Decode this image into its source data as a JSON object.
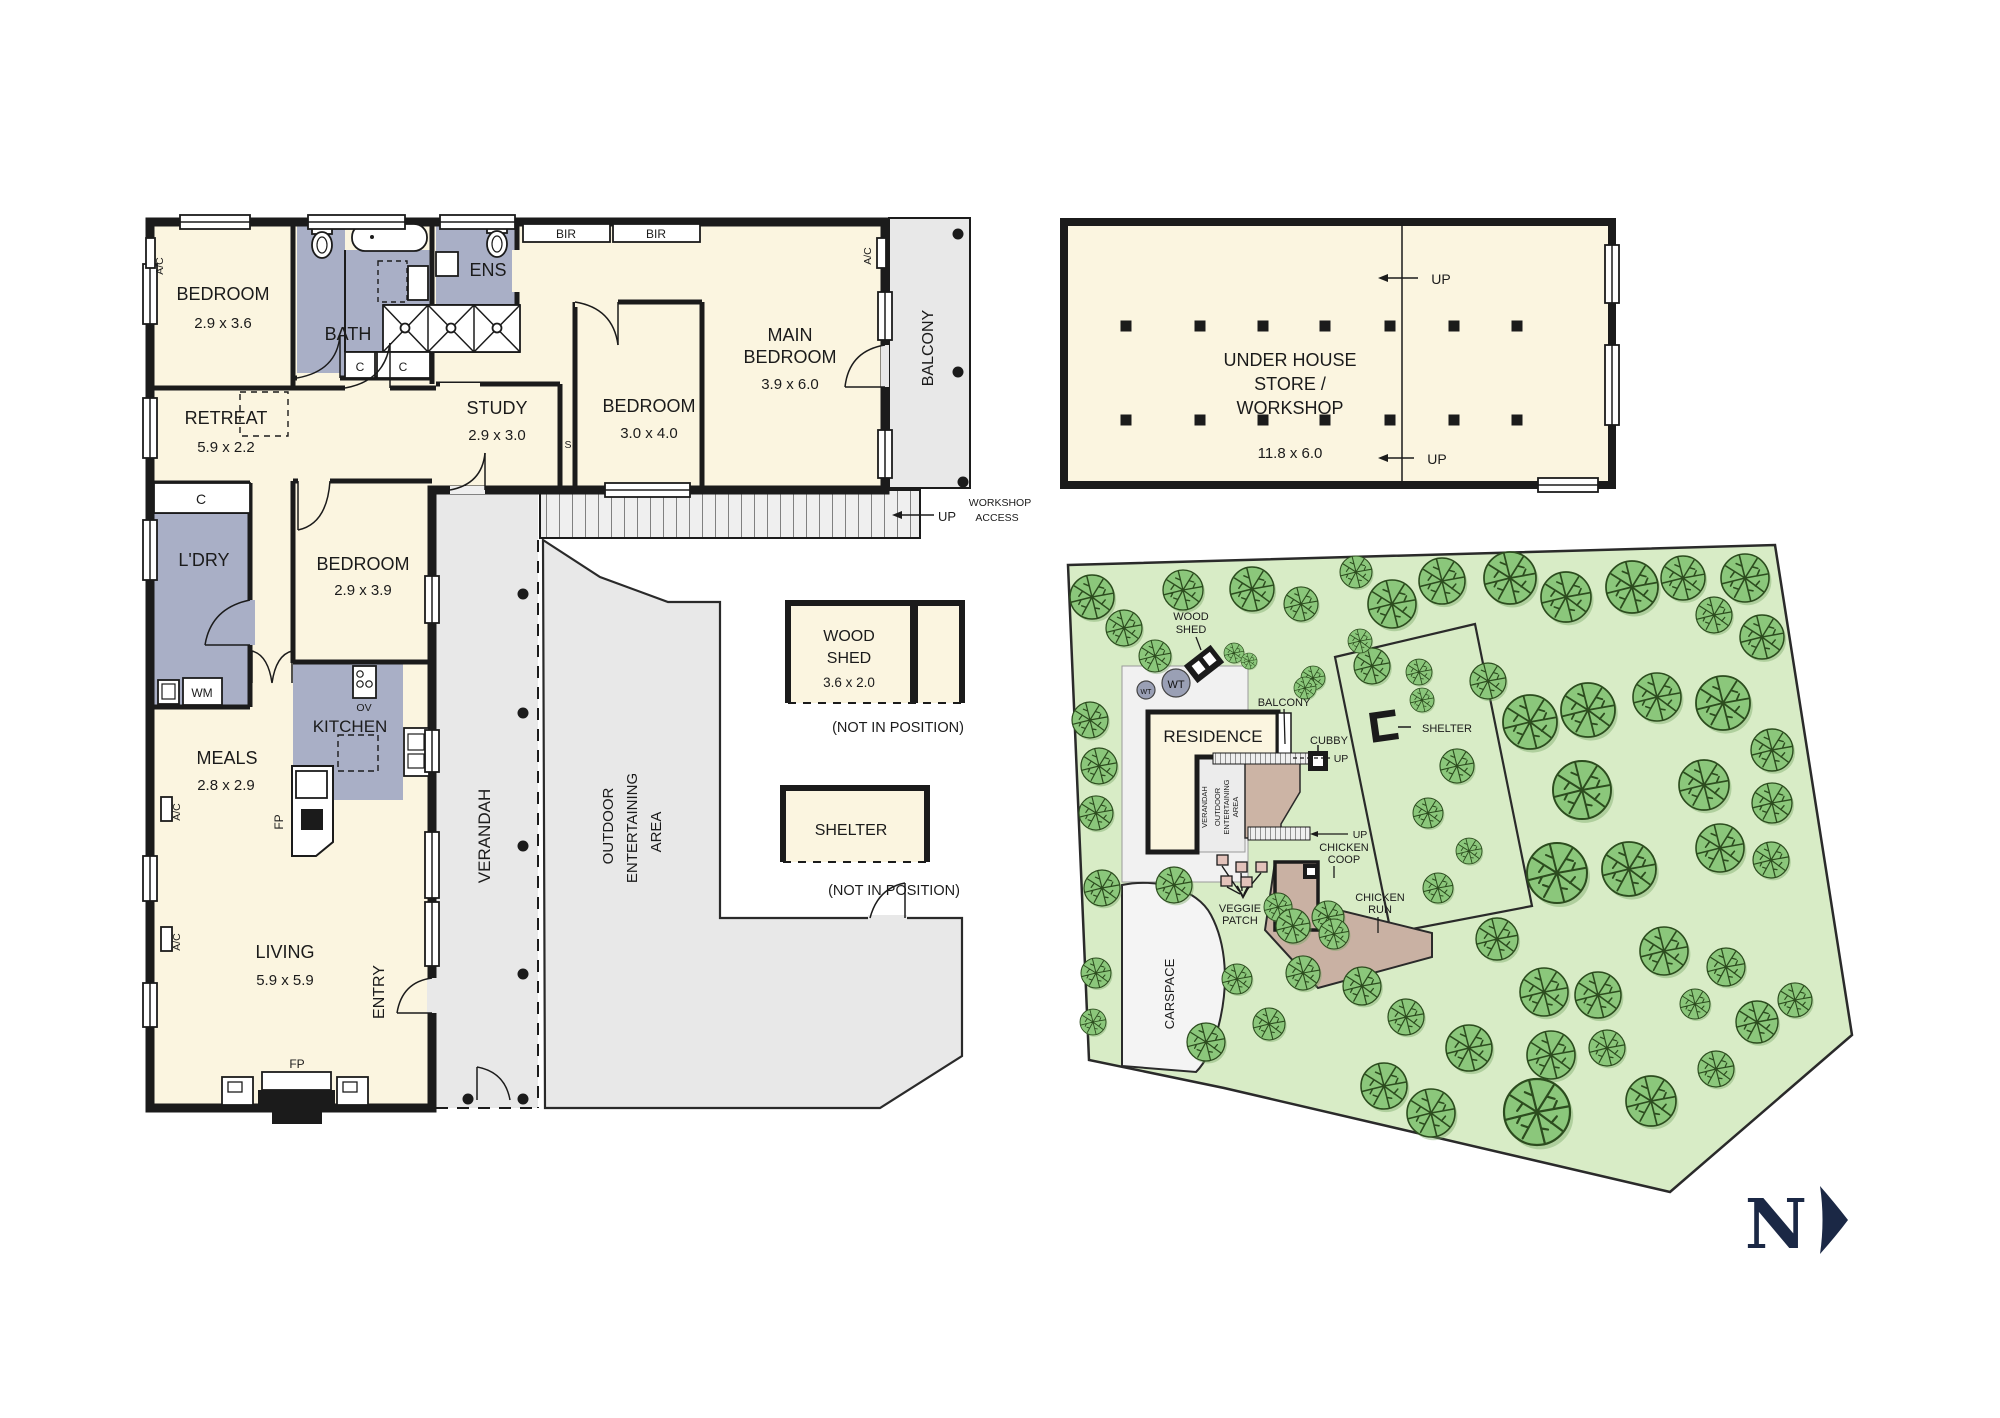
{
  "fp": {
    "bedroom1": [
      "BEDROOM",
      "2.9 x 3.6"
    ],
    "bath": "BATH",
    "ens": "ENS",
    "bir": "BIR",
    "main_bedroom": [
      "MAIN",
      "BEDROOM",
      "3.9 x 6.0"
    ],
    "balcony": "BALCONY",
    "bedroom3": [
      "BEDROOM",
      "3.0 x 4.0"
    ],
    "study": [
      "STUDY",
      "2.9 x 3.0"
    ],
    "retreat": [
      "RETREAT",
      "5.9 x 2.2"
    ],
    "ldry": "L'DRY",
    "bedroom4": [
      "BEDROOM",
      "2.9 x 3.9"
    ],
    "kitchen": "KITCHEN",
    "meals": [
      "MEALS",
      "2.8 x 2.9"
    ],
    "living": [
      "LIVING",
      "5.9 x 5.9"
    ],
    "entry": "ENTRY",
    "verandah": "VERANDAH",
    "outdoor": [
      "OUTDOOR",
      "ENTERTAINING",
      "AREA"
    ],
    "ac": "A/C",
    "c": "C",
    "wm": "WM",
    "ov": "OV",
    "fp_label": "FP",
    "s": "S",
    "up": "UP",
    "workshop_access": [
      "WORKSHOP",
      "ACCESS"
    ]
  },
  "workshop": {
    "name": [
      "UNDER HOUSE",
      "STORE /",
      "WORKSHOP"
    ],
    "dims": "11.8 x 6.0",
    "up": "UP",
    "columns": {
      "xs": [
        1126,
        1200,
        1263,
        1325,
        1390,
        1454,
        1517
      ],
      "rows": [
        326,
        420
      ],
      "size": 11
    }
  },
  "woodshed_box": {
    "name": [
      "WOOD",
      "SHED"
    ],
    "dims": "3.6 x 2.0",
    "note": "(NOT IN POSITION)"
  },
  "shelter_box": {
    "name": "SHELTER",
    "note": "(NOT IN POSITION)"
  },
  "site": {
    "residence": "RESIDENCE",
    "balcony": "BALCONY",
    "cubby": "CUBBY",
    "shelter": "SHELTER",
    "wood_shed": [
      "WOOD",
      "SHED"
    ],
    "wt": "WT",
    "verandah": "VERANDAH",
    "outdoor": [
      "OUTDOOR",
      "ENTERTAINING",
      "AREA"
    ],
    "chicken_coop": [
      "CHICKEN",
      "COOP"
    ],
    "chicken_run": [
      "CHICKEN",
      "RUN"
    ],
    "veggie_patch": [
      "VEGGIE",
      "PATCH"
    ],
    "carspace": "CARSPACE",
    "up": "UP",
    "north": "N",
    "trees": [
      [
        1092,
        597,
        22
      ],
      [
        1124,
        628,
        18
      ],
      [
        1155,
        656,
        16
      ],
      [
        1183,
        590,
        20
      ],
      [
        1252,
        589,
        22
      ],
      [
        1301,
        604,
        17
      ],
      [
        1313,
        678,
        12
      ],
      [
        1356,
        572,
        16
      ],
      [
        1392,
        604,
        24
      ],
      [
        1442,
        581,
        23
      ],
      [
        1510,
        578,
        26
      ],
      [
        1566,
        597,
        25
      ],
      [
        1632,
        587,
        26
      ],
      [
        1683,
        578,
        22
      ],
      [
        1745,
        578,
        24
      ],
      [
        1762,
        637,
        22
      ],
      [
        1714,
        615,
        18
      ],
      [
        1488,
        681,
        18
      ],
      [
        1530,
        722,
        27
      ],
      [
        1588,
        710,
        27
      ],
      [
        1657,
        697,
        24
      ],
      [
        1723,
        703,
        27
      ],
      [
        1772,
        750,
        21
      ],
      [
        1582,
        790,
        29
      ],
      [
        1704,
        785,
        25
      ],
      [
        1772,
        803,
        20
      ],
      [
        1557,
        873,
        30
      ],
      [
        1629,
        869,
        27
      ],
      [
        1720,
        848,
        24
      ],
      [
        1771,
        860,
        18
      ],
      [
        1497,
        939,
        21
      ],
      [
        1544,
        992,
        24
      ],
      [
        1598,
        995,
        23
      ],
      [
        1664,
        951,
        24
      ],
      [
        1695,
        1004,
        15
      ],
      [
        1726,
        967,
        19
      ],
      [
        1757,
        1022,
        21
      ],
      [
        1795,
        1000,
        17
      ],
      [
        1469,
        1048,
        23
      ],
      [
        1551,
        1055,
        24
      ],
      [
        1607,
        1048,
        18
      ],
      [
        1651,
        1101,
        25
      ],
      [
        1716,
        1069,
        18
      ],
      [
        1537,
        1112,
        33
      ],
      [
        1431,
        1113,
        24
      ],
      [
        1384,
        1086,
        23
      ],
      [
        1406,
        1017,
        18
      ],
      [
        1362,
        986,
        19
      ],
      [
        1303,
        973,
        17
      ],
      [
        1237,
        979,
        15
      ],
      [
        1278,
        907,
        14
      ],
      [
        1328,
        917,
        16
      ],
      [
        1293,
        926,
        17
      ],
      [
        1334,
        934,
        15
      ],
      [
        1090,
        720,
        18
      ],
      [
        1099,
        766,
        18
      ],
      [
        1096,
        813,
        17
      ],
      [
        1102,
        888,
        18
      ],
      [
        1096,
        973,
        15
      ],
      [
        1093,
        1022,
        13
      ],
      [
        1174,
        885,
        18
      ],
      [
        1206,
        1042,
        19
      ],
      [
        1269,
        1024,
        16
      ],
      [
        1372,
        666,
        18
      ],
      [
        1419,
        672,
        13
      ],
      [
        1422,
        700,
        12
      ],
      [
        1457,
        766,
        17
      ],
      [
        1428,
        813,
        15
      ],
      [
        1469,
        851,
        13
      ],
      [
        1438,
        888,
        15
      ],
      [
        1234,
        653,
        10
      ],
      [
        1249,
        661,
        8
      ],
      [
        1305,
        688,
        11
      ],
      [
        1360,
        641,
        12
      ]
    ]
  },
  "colors": {
    "wall": "#1b1b1b",
    "room_fill": "#FBF5E0",
    "wet_fill": "#A9AFC6",
    "outdoor_gray": "#E8E8E8",
    "site_green": "#D8ECC6",
    "tree_green": "#8BC77B",
    "deck_brown": "#CCB4A5",
    "navy": "#1b2845"
  }
}
